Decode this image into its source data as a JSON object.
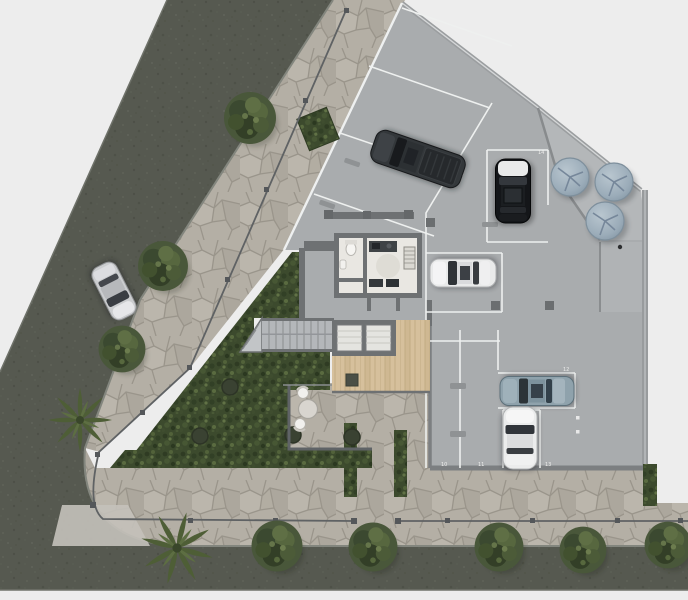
{
  "scene": {
    "type": "architectural-site-plan",
    "view": "top-down",
    "description": "Ground-floor site plan of a corner lot: diagonal and horizontal streets with stone sidewalks, open parking slab with cars, service core, stairs, elevators, wood deck, dense garden and three water tanks"
  },
  "colors": {
    "background": "#ededed",
    "asphalt": "#565950",
    "stone_paving": "#b4afa5",
    "stone_joint": "#9a958b",
    "slab_concrete": "#a9acae",
    "wall": "#6e7173",
    "parking_line": "#eef0ef",
    "garden_green": "#3c4a2d",
    "deck_wood": "#d6c09c",
    "water_tank": "#9fb0bc",
    "fence": "#5f6264"
  },
  "parking": {
    "space_labels": [
      "10",
      "11",
      "12",
      "13",
      "14"
    ]
  },
  "vehicles": [
    {
      "name": "silver-car-on-street",
      "color": "#cbcdcf"
    },
    {
      "name": "dark-suv-angled-space",
      "color": "#33373a"
    },
    {
      "name": "black-car-white-hood",
      "color": "#141619"
    },
    {
      "name": "white-sedan-center",
      "color": "#e9eaea"
    },
    {
      "name": "steel-blue-sedan",
      "color": "#8fa2ac"
    },
    {
      "name": "white-car-south",
      "color": "#ebecec"
    }
  ],
  "site_features": {
    "water_tanks": 3,
    "elevator_cells": 2,
    "staircases": 1,
    "street_trees": 8,
    "palm_trees": 2,
    "garden_planters": 4,
    "patio_table_seats": 2
  }
}
